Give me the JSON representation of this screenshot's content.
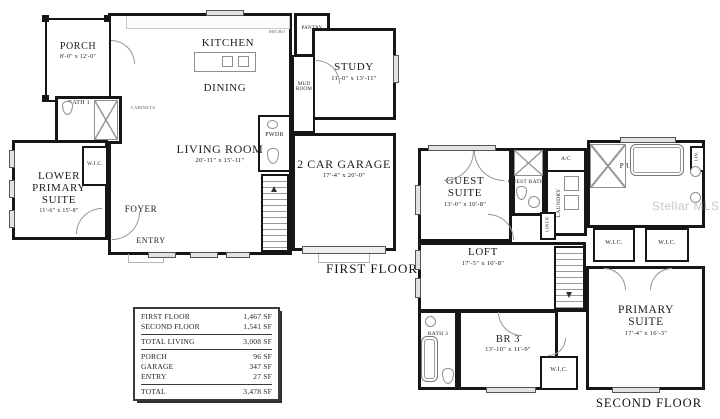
{
  "watermark": "Stellar MLS",
  "colors": {
    "wall": "#161616",
    "window-fill": "#e2e2e2",
    "fixture": "#8f8f8f",
    "text": "#1c1c1c"
  },
  "first_floor": {
    "caption": "FIRST FLOOR",
    "rooms": {
      "porch": {
        "name": "PORCH",
        "dim": "8'-0\" x 12'-0\""
      },
      "kitchen": {
        "name": "KITCHEN"
      },
      "dining": {
        "name": "DINING"
      },
      "pantry": {
        "name": "PANTRY"
      },
      "micro": {
        "name": "MICRO"
      },
      "cabinets": {
        "name": "CABINETS"
      },
      "mud_room": {
        "name": "MUD ROOM"
      },
      "study": {
        "name": "STUDY",
        "dim": "11'-0\" x 13'-11\""
      },
      "living_room": {
        "name": "LIVING ROOM",
        "dim": "20'-11\" x 15'-11\""
      },
      "lower_primary_suite": {
        "name": "LOWER PRIMARY SUITE",
        "dim": "11'-6\" x 15'-8\""
      },
      "bath_1": {
        "name": "BATH 1"
      },
      "wic": {
        "name": "W.I.C."
      },
      "foyer": {
        "name": "FOYER"
      },
      "entry": {
        "name": "ENTRY"
      },
      "pwdr": {
        "name": "PWDR"
      },
      "garage": {
        "name": "2 CAR GARAGE",
        "dim": "17'-4\" x 20'-0\""
      }
    }
  },
  "second_floor": {
    "caption": "SECOND FLOOR",
    "rooms": {
      "guest_suite": {
        "name": "GUEST SUITE",
        "dim": "13'-0\" x 10'-8\""
      },
      "guest_bath": {
        "name": "GUEST BATH"
      },
      "laundry": {
        "name": "LAUNDRY"
      },
      "ac": {
        "name": "A/C"
      },
      "linen": {
        "name": "LINEN"
      },
      "lin": {
        "name": "LIN."
      },
      "primary_bath": {
        "name": "PRIMARY BATH"
      },
      "wic_left": {
        "name": "W.I.C."
      },
      "wic_right": {
        "name": "W.I.C."
      },
      "loft": {
        "name": "LOFT",
        "dim": "17'-5\" x 10'-8\""
      },
      "br3": {
        "name": "BR 3",
        "dim": "13'-10\" x 11'-9\""
      },
      "bath_3": {
        "name": "BATH 3"
      },
      "wic_br3": {
        "name": "W.I.C."
      },
      "primary_suite": {
        "name": "PRIMARY SUITE",
        "dim": "17'-4\" x 16'-3\""
      }
    }
  },
  "area_table": {
    "rows": [
      {
        "label": "FIRST FLOOR",
        "value": "1,467 SF"
      },
      {
        "label": "SECOND FLOOR",
        "value": "1,541 SF"
      },
      {
        "label": "TOTAL LIVING",
        "value": "3,008 SF"
      },
      {
        "label": "PORCH",
        "value": "96 SF"
      },
      {
        "label": "GARAGE",
        "value": "347 SF"
      },
      {
        "label": "ENTRY",
        "value": "27 SF"
      },
      {
        "label": "TOTAL",
        "value": "3,478 SF"
      }
    ]
  }
}
